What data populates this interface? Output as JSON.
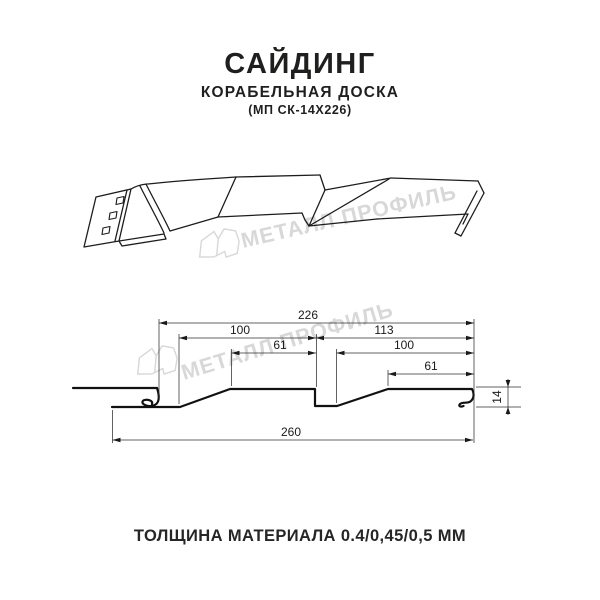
{
  "header": {
    "title": "САЙДИНГ",
    "subtitle": "КОРАБЕЛЬНАЯ ДОСКА",
    "code": "(МП СК-14Х226)"
  },
  "footer": {
    "thickness_note": "ТОЛЩИНА МАТЕРИАЛА 0.4/0,45/0,5 ММ"
  },
  "watermark": {
    "text": "МЕТАЛЛ ПРОФИЛЬ",
    "color": "#d8d8d8"
  },
  "diagram": {
    "dims": {
      "overall_top": "226",
      "left_upper": "100",
      "right_upper": "113",
      "left_inner": "61",
      "right_inner": "100",
      "right_small": "61",
      "total_width": "260",
      "height": "14"
    }
  },
  "colors": {
    "line": "#1d1d1b",
    "background": "#ffffff"
  }
}
